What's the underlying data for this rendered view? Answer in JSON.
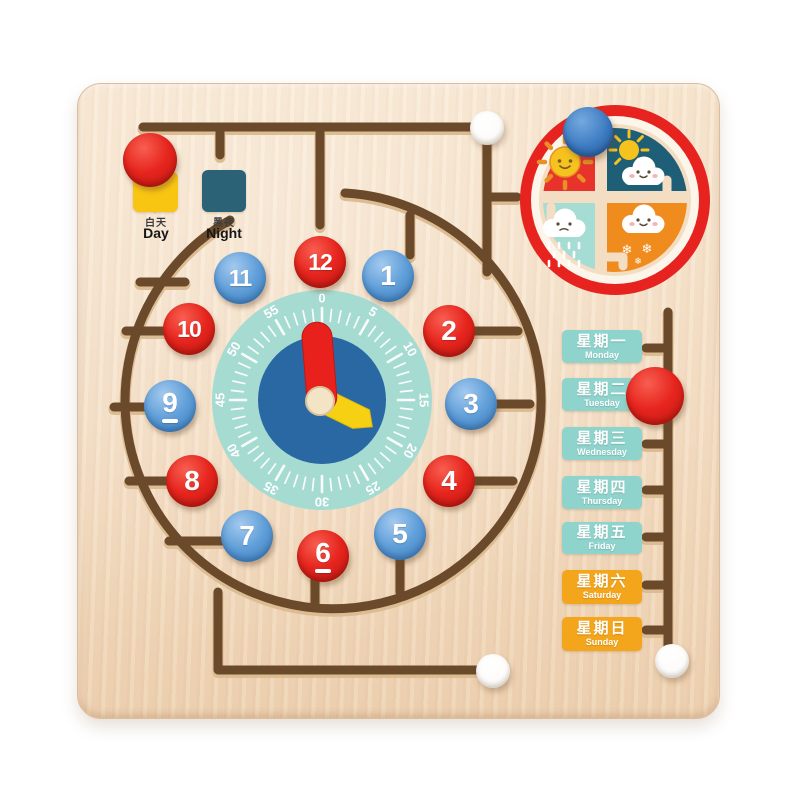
{
  "board": {
    "wood_color": "#f4dec4",
    "groove_color": "#6b4a2b"
  },
  "day_night": {
    "day": {
      "zh": "白天",
      "en": "Day",
      "card_color": "#f9c513",
      "icon": "sun-icon"
    },
    "night": {
      "zh": "黑夜",
      "en": "Night",
      "card_color": "#2b6276",
      "icon": "moon-icon"
    }
  },
  "clock": {
    "face_color": "#a6dbd2",
    "inner_color": "#2a68a3",
    "hour_hand_color": "#e8211d",
    "minute_hand_color": "#f6d012",
    "hub_color": "#f4e4c6",
    "hour_hand_angle_deg": -4.5,
    "minute_hand_angle_deg": 116,
    "minutes": [
      "0",
      "5",
      "10",
      "15",
      "20",
      "25",
      "30",
      "35",
      "40",
      "45",
      "50",
      "55"
    ],
    "underlined": [
      "6",
      "9"
    ],
    "hours": [
      {
        "label": "12",
        "color": "red"
      },
      {
        "label": "1",
        "color": "blue"
      },
      {
        "label": "2",
        "color": "red"
      },
      {
        "label": "3",
        "color": "blue"
      },
      {
        "label": "4",
        "color": "red"
      },
      {
        "label": "5",
        "color": "blue"
      },
      {
        "label": "6",
        "color": "red"
      },
      {
        "label": "7",
        "color": "blue"
      },
      {
        "label": "8",
        "color": "red"
      },
      {
        "label": "9",
        "color": "blue"
      },
      {
        "label": "10",
        "color": "red"
      },
      {
        "label": "11",
        "color": "blue"
      }
    ],
    "knob_red": "#e6251e",
    "knob_blue": "#5f9ed8"
  },
  "weather": {
    "ring_color": "#e6231f",
    "inner_ring_color": "#fbf5ea",
    "quadrants": [
      {
        "name": "sunny",
        "icon": "sun-icon",
        "color": "#e8332a"
      },
      {
        "name": "partly-cloudy",
        "icon": "sun-cloud-icon",
        "color": "#1f5e77"
      },
      {
        "name": "rainy",
        "icon": "rain-cloud-icon",
        "color": "#a5dcd3"
      },
      {
        "name": "snowy",
        "icon": "snow-cloud-icon",
        "color": "#f08c1e"
      }
    ],
    "snowflake_glyph": "❄"
  },
  "week": {
    "teal_color": "#8ed3cc",
    "orange_color": "#f3a51b",
    "days": [
      {
        "zh": "星期一",
        "en": "Monday",
        "color": "#8ed3cc"
      },
      {
        "zh": "星期二",
        "en": "Tuesday",
        "color": "#8ed3cc"
      },
      {
        "zh": "星期三",
        "en": "Wednesday",
        "color": "#8ed3cc"
      },
      {
        "zh": "星期四",
        "en": "Thursday",
        "color": "#8ed3cc"
      },
      {
        "zh": "星期五",
        "en": "Friday",
        "color": "#8ed3cc"
      },
      {
        "zh": "星期六",
        "en": "Saturday",
        "color": "#f3a51b"
      },
      {
        "zh": "星期日",
        "en": "Sunday",
        "color": "#f3a51b"
      }
    ]
  },
  "loose_knobs": [
    {
      "name": "red-knob-day",
      "color": "red-big"
    },
    {
      "name": "white-knob-top",
      "color": "white"
    },
    {
      "name": "blue-knob-weather",
      "color": "blue-big"
    },
    {
      "name": "red-knob-week",
      "color": "red-big"
    },
    {
      "name": "white-knob-bottom",
      "color": "white"
    },
    {
      "name": "white-knob-bottom-right",
      "color": "white"
    }
  ]
}
